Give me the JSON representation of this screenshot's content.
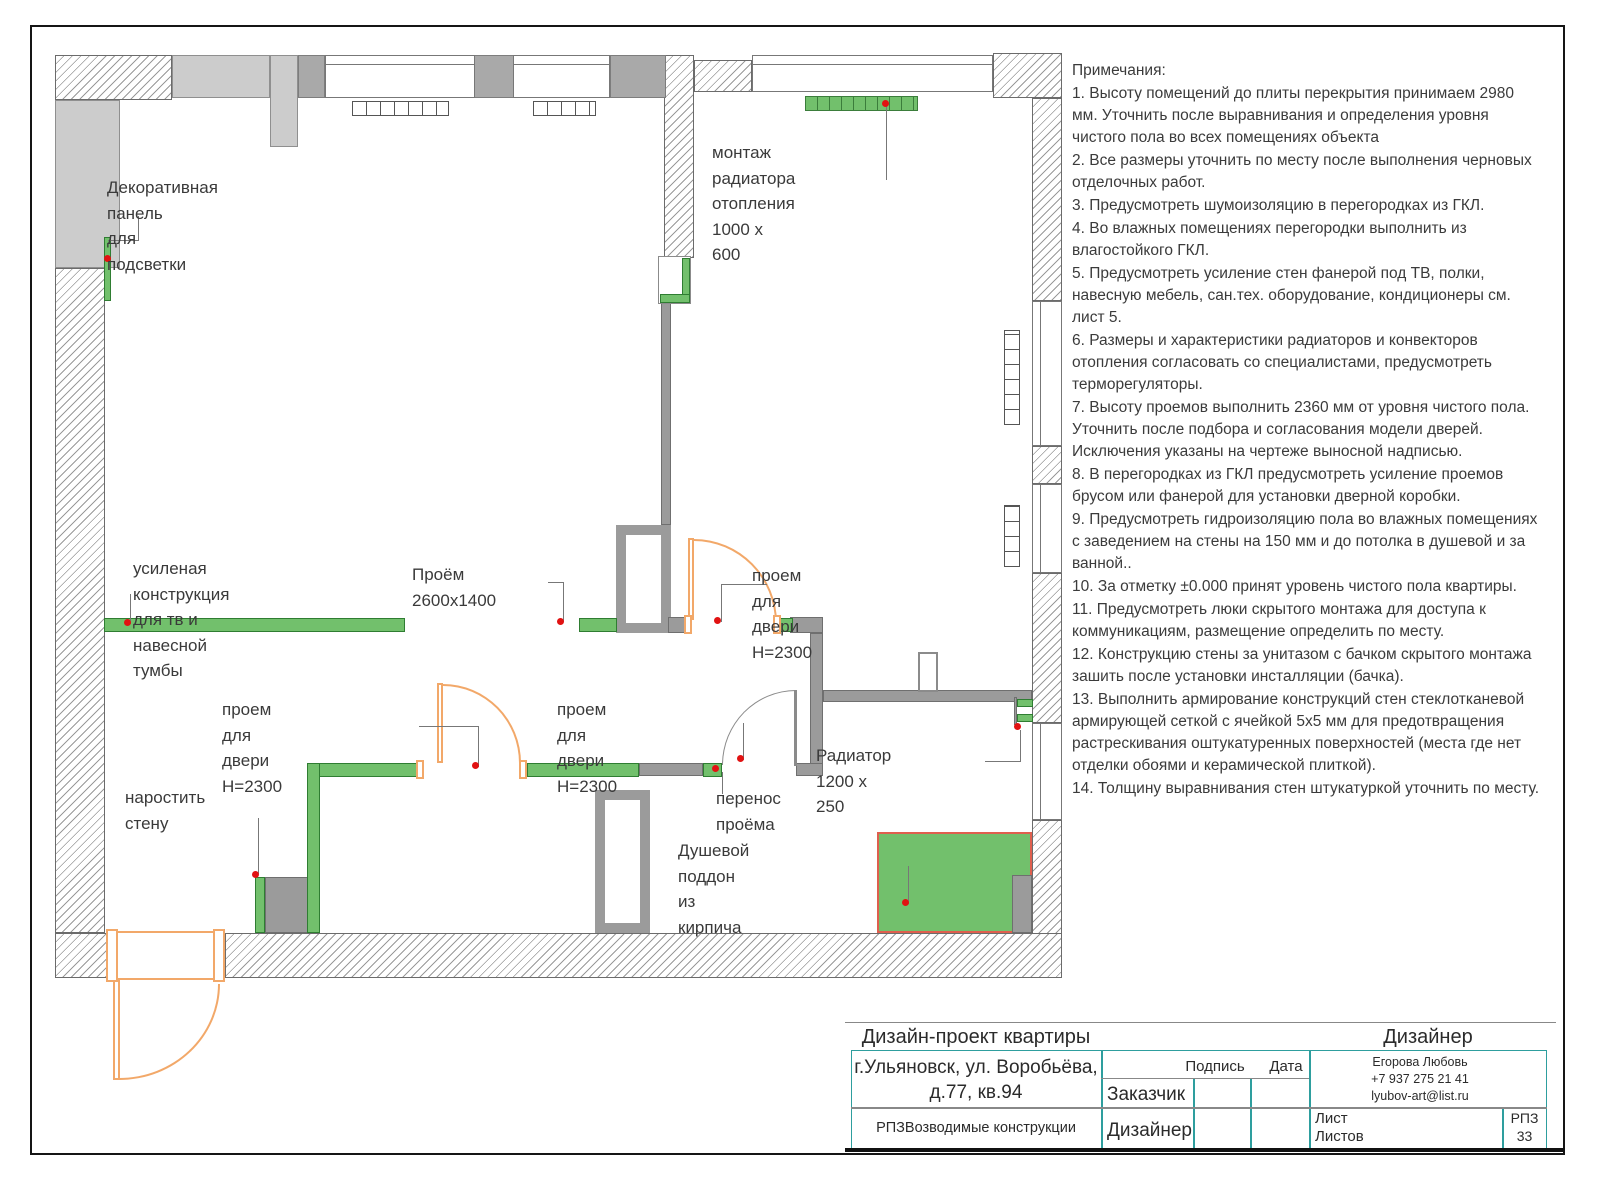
{
  "plan": {
    "labels": {
      "decor_panel": "Декоративная панель\nдля подсветки",
      "radiator_mount": "монтаж радиатора\nотопления 1000 x 600",
      "tv_wall": "усиленая конструкция\nдля тв и навесной тумбы",
      "opening": "Проём 2600x1400",
      "door_top": "проем для двери Н=2300",
      "door_left": "проем для двери Н=2300",
      "door_right": "проем для двери Н=2300",
      "opening_transfer": "перенос проёма",
      "radiator_small": "Радиатор 1200 x 250",
      "shower_tray": "Душевой поддон из кирпича",
      "grow_wall": "наростить стену"
    }
  },
  "notes": {
    "title": "Примечания:",
    "items": [
      "1. Высоту помещений до плиты перекрытия принимаем 2980 мм. Уточнить после выравнивания и определения уровня чистого пола во всех помещениях объекта",
      "2. Все размеры уточнить по месту после выполнения черновых отделочных работ.",
      "3. Предусмотреть шумоизоляцию в перегородках из ГКЛ.",
      "4. Во влажных помещениях перегородки выполнить из влагостойкого ГКЛ.",
      "5. Предусмотреть усиление стен фанерой под ТВ, полки, навесную мебель, сан.тех. оборудование, кондиционеры см. лист 5.",
      "6. Размеры и характеристики радиаторов и конвекторов отопления согласовать со специалистами, предусмотреть терморегуляторы.",
      "7. Высоту проемов выполнить 2360 мм от уровня чистого пола. Уточнить после подбора и согласования модели дверей. Исключения указаны на чертеже выносной надписью.",
      "8. В перегородках из ГКЛ предусмотреть усиление проемов брусом или фанерой для установки дверной коробки.",
      "9. Предусмотреть гидроизоляцию пола во влажных помещениях с заведением на стены на 150 мм и до потолка в душевой и за ванной..",
      "10. За отметку ±0.000 принят уровень чистого пола квартиры.",
      "11. Предусмотреть люки скрытого монтажа для доступа к коммуникациям, размещение определить по месту.",
      "12. Конструкцию стены за унитазом с бачком скрытого монтажа зашить после установки инсталляции (бачка).",
      "13. Выполнить армирование конструкций стен стеклотканевой армирующей сеткой с ячейкой 5х5 мм для предотвращения растрескивания оштукатуренных поверхностей (места где нет отделки обоями и керамической плиткой).",
      "14. Толщину выравнивания стен штукатуркой уточнить по месту."
    ]
  },
  "title_block": {
    "project": "Дизайн-проект квартиры",
    "designer_header": "Дизайнер",
    "address_line1": "г.Ульяновск, ул. Воробьёва,",
    "address_line2": "д.77, кв.94",
    "doc_title": "РПЗВозводимые конструкции",
    "col_signature": "Подпись",
    "col_date": "Дата",
    "row_client": "Заказчик",
    "row_designer": "Дизайнер",
    "contact_name": "Егорова Любовь",
    "contact_phone": "+7 937 275 21 41",
    "contact_email": "lyubov-art@list.ru",
    "sheet_label": "Лист",
    "sheets_label": "Листов",
    "doc_code": "РПЗ",
    "sheet_number": "33"
  },
  "colors": {
    "new_construction_green": "#72c06c",
    "door_orange": "#f2a869",
    "marker_red": "#e11212",
    "table_teal": "#2e9e9e",
    "wall_gray": "#9b9b9b"
  }
}
